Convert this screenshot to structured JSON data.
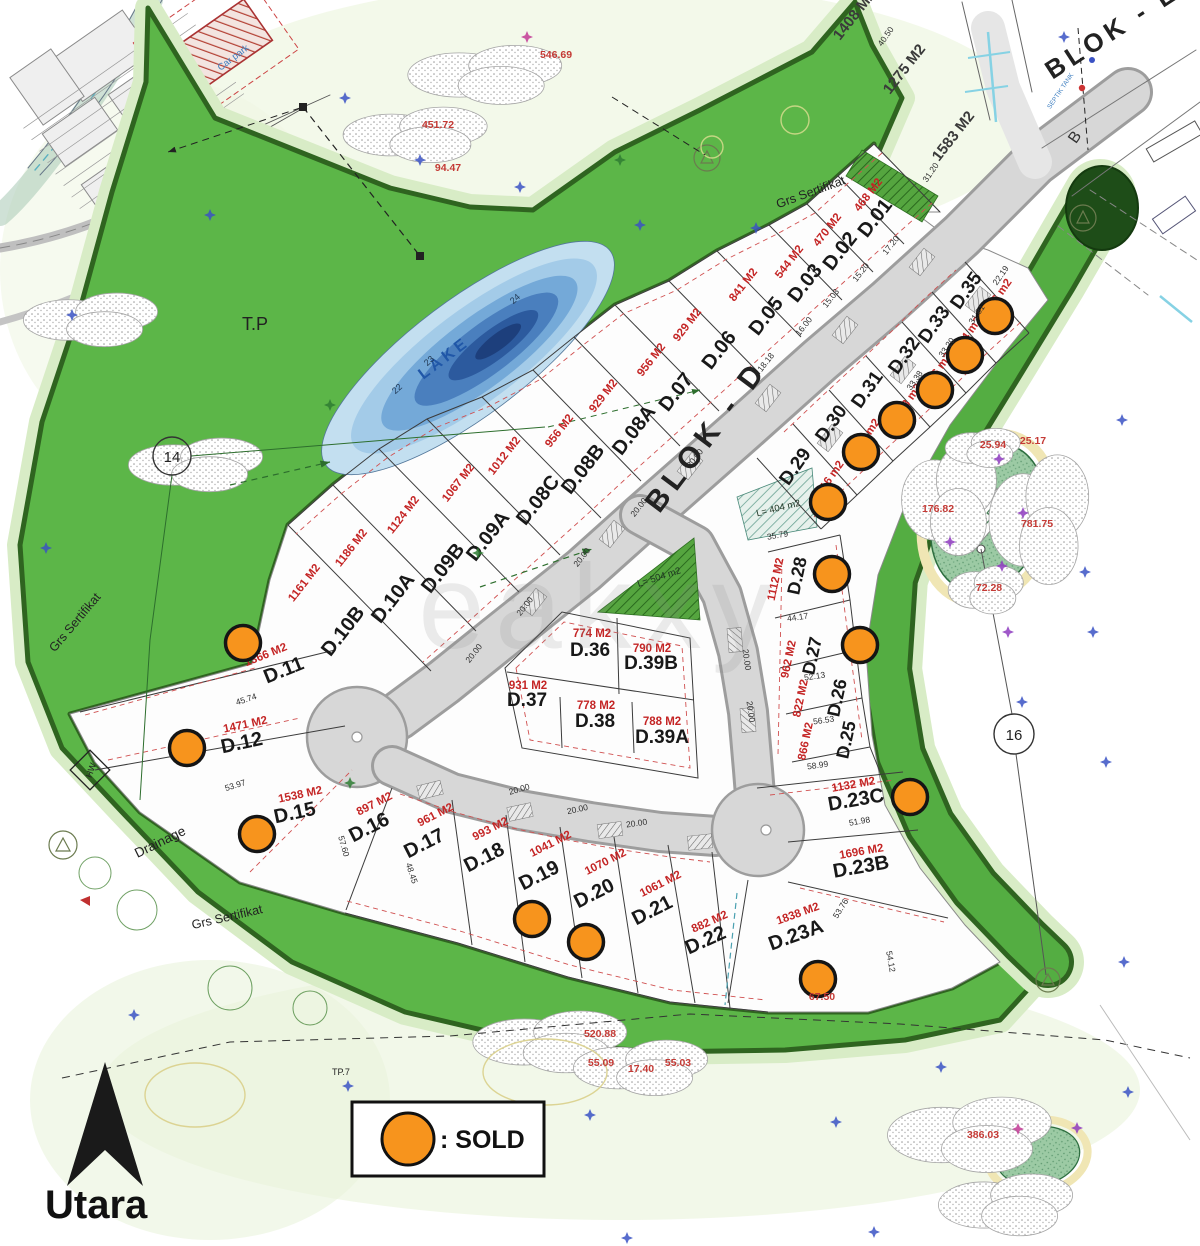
{
  "legend": {
    "sold_label": ": SOLD"
  },
  "compass": {
    "label": "Utara"
  },
  "map_labels": {
    "blok_d": "BLOK - D",
    "blok_e": "BLOK - E",
    "lake": "LAKE",
    "green_pond": "GREEN",
    "tp": "T.P",
    "tp7": "TP.7",
    "hw": "HW",
    "drainage": "Drainage",
    "grs_sertifikat": "Grs Sertifikat",
    "l504": "L= 504 m2",
    "l404": "L= 404 m2",
    "circle_14": "14",
    "circle_16": "16",
    "contour_22": "22",
    "contour_23": "23",
    "contour_24": "24",
    "car_park": "Car park",
    "septik": "SEPTIK TANK",
    "road_b": "B",
    "watermark": "eakxy"
  },
  "top_plots": [
    {
      "area": "1408 M2",
      "x": 858,
      "y": 18,
      "r": -52
    },
    {
      "area": "1275 M2",
      "x": 908,
      "y": 72,
      "r": -52
    },
    {
      "area": "1583 M2",
      "x": 957,
      "y": 139,
      "r": -52
    }
  ],
  "plots": [
    {
      "id": "D.01",
      "area": "468 M2",
      "x": 880,
      "y": 222,
      "r": -52,
      "ax": 871,
      "ay": 197,
      "ar": -52
    },
    {
      "id": "D.02",
      "area": "470 M2",
      "x": 845,
      "y": 255,
      "r": -52,
      "ax": 830,
      "ay": 232,
      "ar": -52
    },
    {
      "id": "D.03",
      "area": "544 M2",
      "x": 810,
      "y": 287,
      "r": -52,
      "ax": 792,
      "ay": 264,
      "ar": -52
    },
    {
      "id": "D.05",
      "area": "841 M2",
      "x": 771,
      "y": 320,
      "r": -52,
      "ax": 746,
      "ay": 287,
      "ar": -52
    },
    {
      "id": "D.06",
      "area": "929 M2",
      "x": 724,
      "y": 354,
      "r": -52,
      "ax": 690,
      "ay": 327,
      "ar": -52
    },
    {
      "id": "D.07",
      "area": "956 M2",
      "x": 681,
      "y": 396,
      "r": -52,
      "ax": 654,
      "ay": 362,
      "ar": -52
    },
    {
      "id": "D.08A",
      "area": "929 M2",
      "x": 639,
      "y": 434,
      "r": -52,
      "ax": 606,
      "ay": 398,
      "ar": -52
    },
    {
      "id": "D.08B",
      "area": "956 M2",
      "x": 588,
      "y": 473,
      "r": -52,
      "ax": 562,
      "ay": 433,
      "ar": -52
    },
    {
      "id": "D.08C",
      "area": "1012 M2",
      "x": 543,
      "y": 504,
      "r": -52,
      "ax": 507,
      "ay": 458,
      "ar": -52
    },
    {
      "id": "D.09A",
      "area": "1067 M2",
      "x": 493,
      "y": 540,
      "r": -52,
      "ax": 461,
      "ay": 485,
      "ar": -52
    },
    {
      "id": "D.09B",
      "area": "1124 M2",
      "x": 448,
      "y": 572,
      "r": -52,
      "ax": 406,
      "ay": 517,
      "ar": -52
    },
    {
      "id": "D.10A",
      "area": "1186 M2",
      "x": 398,
      "y": 602,
      "r": -52,
      "ax": 354,
      "ay": 550,
      "ar": -52
    },
    {
      "id": "D.10B",
      "area": "1161 M2",
      "x": 348,
      "y": 635,
      "r": -52,
      "ax": 307,
      "ay": 585,
      "ar": -52
    },
    {
      "id": "D.11",
      "area": "1366 M2",
      "x": 286,
      "y": 676,
      "r": -22,
      "ax": 267,
      "ay": 658,
      "ar": -22,
      "sold": 1,
      "sx": 243,
      "sy": 643
    },
    {
      "id": "D.12",
      "area": "1471 M2",
      "x": 243,
      "y": 749,
      "r": -12,
      "ax": 246,
      "ay": 728,
      "ar": -12,
      "sold": 1,
      "sx": 187,
      "sy": 748
    },
    {
      "id": "D.15",
      "area": "1538 M2",
      "x": 296,
      "y": 819,
      "r": -12,
      "ax": 301,
      "ay": 798,
      "ar": -12,
      "sold": 1,
      "sx": 257,
      "sy": 834
    },
    {
      "id": "D.16",
      "area": "897 M2",
      "x": 372,
      "y": 833,
      "r": -27,
      "ax": 376,
      "ay": 807,
      "ar": -27
    },
    {
      "id": "D.17",
      "area": "961 M2",
      "x": 427,
      "y": 849,
      "r": -27,
      "ax": 437,
      "ay": 818,
      "ar": -27
    },
    {
      "id": "D.18",
      "area": "993 M2",
      "x": 487,
      "y": 863,
      "r": -27,
      "ax": 492,
      "ay": 832,
      "ar": -27
    },
    {
      "id": "D.19",
      "area": "1041 M2",
      "x": 542,
      "y": 881,
      "r": -27,
      "ax": 552,
      "ay": 847,
      "ar": -27,
      "sold": 1,
      "sx": 532,
      "sy": 919
    },
    {
      "id": "D.20",
      "area": "1070 M2",
      "x": 597,
      "y": 899,
      "r": -27,
      "ax": 607,
      "ay": 865,
      "ar": -27,
      "sold": 1,
      "sx": 586,
      "sy": 942
    },
    {
      "id": "D.21",
      "area": "1061 M2",
      "x": 655,
      "y": 916,
      "r": -27,
      "ax": 662,
      "ay": 887,
      "ar": -27
    },
    {
      "id": "D.22",
      "area": "882 M2",
      "x": 708,
      "y": 946,
      "r": -24,
      "ax": 711,
      "ay": 925,
      "ar": -24
    },
    {
      "id": "D.23A",
      "area": "1838 M2",
      "x": 798,
      "y": 941,
      "r": -20,
      "ax": 799,
      "ay": 917,
      "ar": -20,
      "sold": 1,
      "sx": 818,
      "sy": 979
    },
    {
      "id": "D.23B",
      "area": "1696 M2",
      "x": 862,
      "y": 873,
      "r": -10,
      "ax": 862,
      "ay": 855,
      "ar": -10
    },
    {
      "id": "D.23C",
      "area": "1132 M2",
      "x": 857,
      "y": 806,
      "r": -10,
      "ax": 854,
      "ay": 788,
      "ar": -10,
      "sold": 1,
      "sx": 910,
      "sy": 797
    },
    {
      "id": "D.29",
      "area": "616 m2",
      "x": 800,
      "y": 470,
      "r": -55,
      "ax": 833,
      "ay": 480,
      "ar": -55,
      "fs": 19,
      "sold": 1,
      "sx": 828,
      "sy": 502
    },
    {
      "id": "D.30",
      "area": "533 m2",
      "x": 836,
      "y": 427,
      "r": -55,
      "ax": 869,
      "ay": 438,
      "ar": -55,
      "fs": 19,
      "sold": 1,
      "sx": 861,
      "sy": 452
    },
    {
      "id": "D.31",
      "area": "503 m2",
      "x": 872,
      "y": 393,
      "r": -55,
      "ax": 911,
      "ay": 403,
      "ar": -55,
      "fs": 19,
      "sold": 1,
      "sx": 897,
      "sy": 420
    },
    {
      "id": "D.32",
      "area": "536 m2",
      "x": 909,
      "y": 359,
      "r": -55,
      "ax": 941,
      "ay": 372,
      "ar": -55,
      "fs": 19,
      "sold": 1,
      "sx": 935,
      "sy": 390
    },
    {
      "id": "D.33",
      "area": "524 m2",
      "x": 939,
      "y": 328,
      "r": -55,
      "ax": 971,
      "ay": 336,
      "ar": -55,
      "fs": 19,
      "sold": 1,
      "sx": 965,
      "sy": 355
    },
    {
      "id": "D.35",
      "area": "476 m2",
      "x": 971,
      "y": 294,
      "r": -55,
      "ax": 1001,
      "ay": 298,
      "ar": -55,
      "fs": 19,
      "sold": 1,
      "sx": 995,
      "sy": 316
    },
    {
      "id": "D.28",
      "area": "1112 M2",
      "x": 803,
      "y": 577,
      "r": -78,
      "ax": 779,
      "ay": 580,
      "ar": -78,
      "fs": 18,
      "sold": 1,
      "sx": 832,
      "sy": 574
    },
    {
      "id": "D.27",
      "area": "962 M2",
      "x": 818,
      "y": 657,
      "r": -78,
      "ax": 792,
      "ay": 660,
      "ar": -78,
      "fs": 18,
      "sold": 1,
      "sx": 860,
      "sy": 645
    },
    {
      "id": "D.26",
      "area": "822 M2",
      "x": 843,
      "y": 699,
      "r": -78,
      "ax": 804,
      "ay": 699,
      "ar": -78,
      "fs": 18
    },
    {
      "id": "D.25",
      "area": "866 M2",
      "x": 852,
      "y": 741,
      "r": -78,
      "ax": 809,
      "ay": 742,
      "ar": -78,
      "fs": 18
    },
    {
      "id": "D.36",
      "area": "774 M2",
      "x": 590,
      "y": 656,
      "r": 0,
      "ax": 592,
      "ay": 637,
      "ar": 0,
      "fs": 19
    },
    {
      "id": "D.39B",
      "area": "790 M2",
      "x": 651,
      "y": 669,
      "r": 0,
      "ax": 652,
      "ay": 652,
      "ar": 0,
      "fs": 19
    },
    {
      "id": "D.37",
      "area": "931 M2",
      "x": 527,
      "y": 706,
      "r": 0,
      "ax": 528,
      "ay": 689,
      "ar": 0,
      "fs": 19
    },
    {
      "id": "D.38",
      "area": "778 M2",
      "x": 595,
      "y": 727,
      "r": 0,
      "ax": 596,
      "ay": 709,
      "ar": 0,
      "fs": 19
    },
    {
      "id": "D.39A",
      "area": "788 M2",
      "x": 662,
      "y": 743,
      "r": 0,
      "ax": 662,
      "ay": 725,
      "ar": 0,
      "fs": 19
    }
  ],
  "dims": [
    {
      "t": "20.00",
      "x": 697,
      "y": 460,
      "r": -52
    },
    {
      "t": "20.00",
      "x": 641,
      "y": 509,
      "r": -52
    },
    {
      "t": "20.00",
      "x": 584,
      "y": 559,
      "r": -52
    },
    {
      "t": "20.00",
      "x": 527,
      "y": 608,
      "r": -52
    },
    {
      "t": "20.00",
      "x": 476,
      "y": 655,
      "r": -52
    },
    {
      "t": "20.00",
      "x": 520,
      "y": 792,
      "r": -16
    },
    {
      "t": "20.00",
      "x": 578,
      "y": 812,
      "r": -12
    },
    {
      "t": "20.00",
      "x": 637,
      "y": 826,
      "r": -8
    },
    {
      "t": "20.00",
      "x": 744,
      "y": 660,
      "r": 82
    },
    {
      "t": "20.00",
      "x": 748,
      "y": 712,
      "r": 82
    },
    {
      "t": "17.20",
      "x": 893,
      "y": 247,
      "r": -52
    },
    {
      "t": "15.20",
      "x": 863,
      "y": 274,
      "r": -52
    },
    {
      "t": "15.03",
      "x": 833,
      "y": 300,
      "r": -52
    },
    {
      "t": "16.00",
      "x": 806,
      "y": 328,
      "r": -52
    },
    {
      "t": "18.18",
      "x": 768,
      "y": 364,
      "r": -52
    },
    {
      "t": "33.38",
      "x": 917,
      "y": 382,
      "r": -55
    },
    {
      "t": "33.20",
      "x": 949,
      "y": 349,
      "r": -55
    },
    {
      "t": "31.81",
      "x": 979,
      "y": 316,
      "r": -55
    },
    {
      "t": "22.19",
      "x": 1003,
      "y": 277,
      "r": -55
    },
    {
      "t": "45.74",
      "x": 247,
      "y": 702,
      "r": -18
    },
    {
      "t": "53.97",
      "x": 236,
      "y": 788,
      "r": -17
    },
    {
      "t": "57.60",
      "x": 341,
      "y": 847,
      "r": 74
    },
    {
      "t": "48.45",
      "x": 409,
      "y": 874,
      "r": 72
    },
    {
      "t": "44.17",
      "x": 798,
      "y": 620,
      "r": -8
    },
    {
      "t": "52.13",
      "x": 815,
      "y": 679,
      "r": -8
    },
    {
      "t": "56.53",
      "x": 824,
      "y": 723,
      "r": -8
    },
    {
      "t": "58.99",
      "x": 818,
      "y": 768,
      "r": -8
    },
    {
      "t": "51.98",
      "x": 860,
      "y": 824,
      "r": -10
    },
    {
      "t": "53.76",
      "x": 843,
      "y": 910,
      "r": -58
    },
    {
      "t": "54.12",
      "x": 888,
      "y": 962,
      "r": 80
    },
    {
      "t": "35.79",
      "x": 778,
      "y": 538,
      "r": -10
    },
    {
      "t": "40.50",
      "x": 888,
      "y": 38,
      "r": -55
    },
    {
      "t": "31.20",
      "x": 933,
      "y": 174,
      "r": -55
    }
  ],
  "elevations": [
    {
      "t": "546.69",
      "x": 556,
      "y": 58
    },
    {
      "t": "451.72",
      "x": 438,
      "y": 128
    },
    {
      "t": "94.47",
      "x": 448,
      "y": 171
    },
    {
      "t": "520.88",
      "x": 600,
      "y": 1037
    },
    {
      "t": "55.09",
      "x": 601,
      "y": 1066
    },
    {
      "t": "17.40",
      "x": 641,
      "y": 1072
    },
    {
      "t": "55.03",
      "x": 678,
      "y": 1066
    },
    {
      "t": "386.03",
      "x": 983,
      "y": 1138
    },
    {
      "t": "176.82",
      "x": 938,
      "y": 512
    },
    {
      "t": "781.75",
      "x": 1037,
      "y": 527
    },
    {
      "t": "25.94",
      "x": 993,
      "y": 448
    },
    {
      "t": "25.17",
      "x": 1033,
      "y": 444
    },
    {
      "t": "72.28",
      "x": 989,
      "y": 591
    },
    {
      "t": "67.50",
      "x": 822,
      "y": 1000
    }
  ],
  "symbols": [
    {
      "x": 345,
      "y": 98,
      "c": "b"
    },
    {
      "x": 527,
      "y": 37,
      "c": "m"
    },
    {
      "x": 420,
      "y": 160,
      "c": "b"
    },
    {
      "x": 520,
      "y": 187,
      "c": "b"
    },
    {
      "x": 640,
      "y": 225,
      "c": "b"
    },
    {
      "x": 756,
      "y": 228,
      "c": "b"
    },
    {
      "x": 72,
      "y": 315,
      "c": "b"
    },
    {
      "x": 46,
      "y": 548,
      "c": "b"
    },
    {
      "x": 210,
      "y": 215,
      "c": "b"
    },
    {
      "x": 620,
      "y": 160,
      "c": "g"
    },
    {
      "x": 330,
      "y": 405,
      "c": "g"
    },
    {
      "x": 478,
      "y": 553,
      "c": "g"
    },
    {
      "x": 350,
      "y": 783,
      "c": "g"
    },
    {
      "x": 134,
      "y": 1015,
      "c": "b"
    },
    {
      "x": 348,
      "y": 1086,
      "c": "b"
    },
    {
      "x": 590,
      "y": 1115,
      "c": "b"
    },
    {
      "x": 836,
      "y": 1122,
      "c": "b"
    },
    {
      "x": 1122,
      "y": 420,
      "c": "b"
    },
    {
      "x": 999,
      "y": 459,
      "c": "p"
    },
    {
      "x": 1023,
      "y": 513,
      "c": "p"
    },
    {
      "x": 1002,
      "y": 566,
      "c": "p"
    },
    {
      "x": 950,
      "y": 542,
      "c": "p"
    },
    {
      "x": 1008,
      "y": 632,
      "c": "p"
    },
    {
      "x": 1085,
      "y": 572,
      "c": "b"
    },
    {
      "x": 1093,
      "y": 632,
      "c": "b"
    },
    {
      "x": 1022,
      "y": 702,
      "c": "b"
    },
    {
      "x": 1106,
      "y": 762,
      "c": "b"
    },
    {
      "x": 1124,
      "y": 962,
      "c": "b"
    },
    {
      "x": 941,
      "y": 1067,
      "c": "b"
    },
    {
      "x": 1128,
      "y": 1092,
      "c": "b"
    },
    {
      "x": 1018,
      "y": 1129,
      "c": "m"
    },
    {
      "x": 1077,
      "y": 1128,
      "c": "p"
    },
    {
      "x": 627,
      "y": 1238,
      "c": "b"
    },
    {
      "x": 874,
      "y": 1232,
      "c": "b"
    },
    {
      "x": 1064,
      "y": 37,
      "c": "b"
    }
  ]
}
